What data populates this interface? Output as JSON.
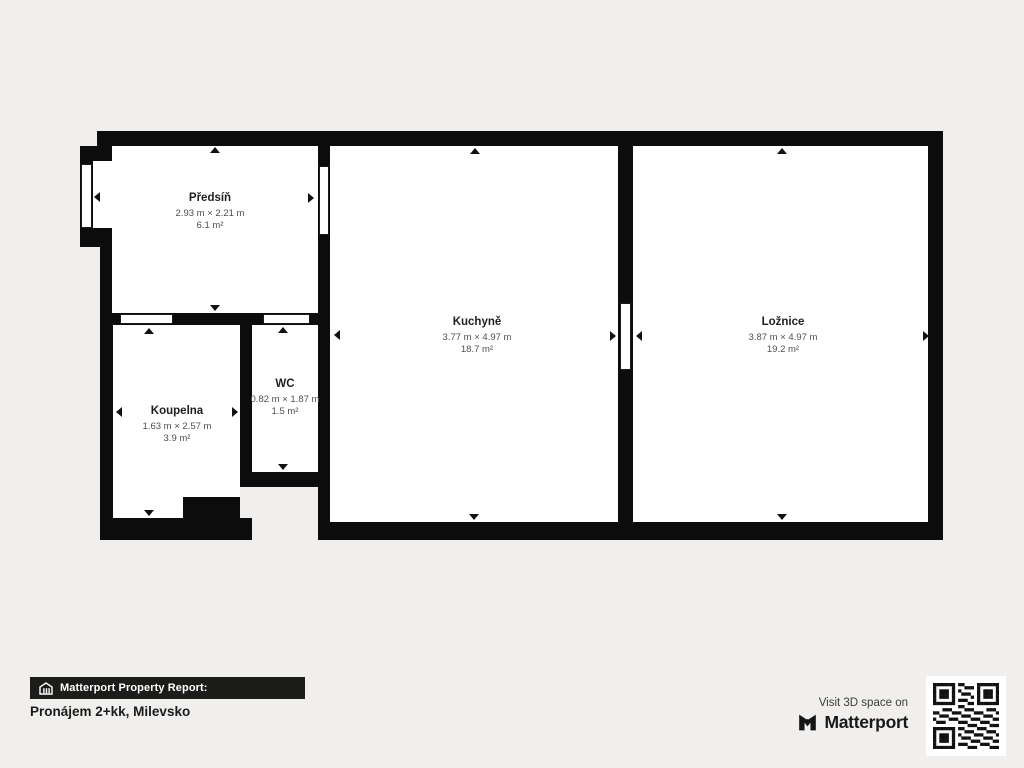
{
  "rooms": [
    {
      "name": "Předsíň",
      "dimensions": "2.93 m × 2.21 m",
      "area": "6.1 m²"
    },
    {
      "name": "Kuchyně",
      "dimensions": "3.77 m × 4.97 m",
      "area": "18.7 m²"
    },
    {
      "name": "Ložnice",
      "dimensions": "3.87 m × 4.97 m",
      "area": "19.2 m²"
    },
    {
      "name": "Koupelna",
      "dimensions": "1.63 m × 2.57 m",
      "area": "3.9 m²"
    },
    {
      "name": "WC",
      "dimensions": "0.82 m × 1.87 m",
      "area": "1.5 m²"
    }
  ],
  "footer": {
    "report_label": "Matterport Property Report:",
    "property_title": "Pronájem 2+kk, Milevsko",
    "visit_text": "Visit 3D space on",
    "brand": "Matterport"
  },
  "icons": {
    "bar_icon": "building-icon",
    "brand_icon": "matterport-m-icon",
    "qr": "qr-code"
  },
  "colors": {
    "background": "#f0efed",
    "wall": "#0c0c0c",
    "room": "#ffffff",
    "footer_bar": "#1c1c1a"
  }
}
